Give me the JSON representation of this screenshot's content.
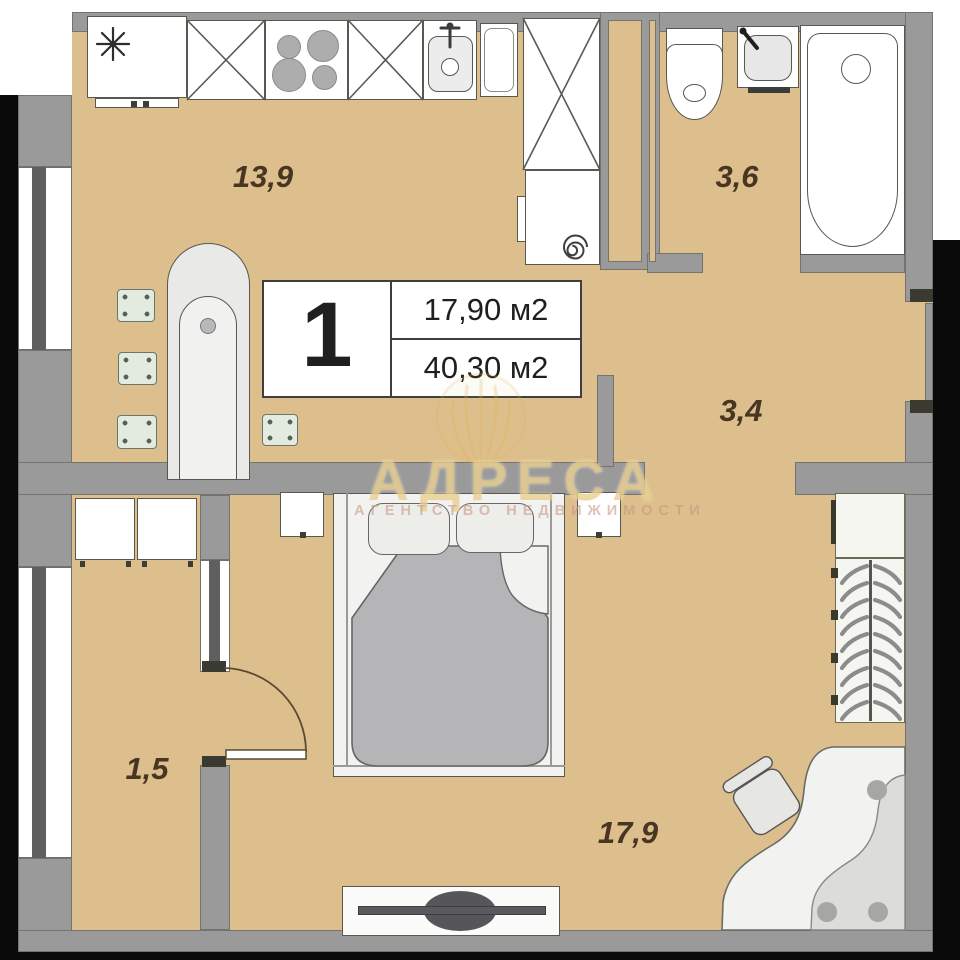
{
  "area_card": {
    "rooms_count": "1",
    "living_area": "17,90 м2",
    "total_area": "40,30 м2"
  },
  "room_labels": {
    "kitchen": "13,9",
    "bathroom": "3,6",
    "hallway": "3,4",
    "balcony": "1,5",
    "living_room": "17,9"
  },
  "watermark": {
    "title": "АДРЕСА",
    "subtitle": "АГЕНТСТВО НЕДВИЖИМОСТИ"
  },
  "colors": {
    "floor": "#ddbf8e",
    "wall": "#9b9a9b",
    "wall_outline": "#74746f",
    "fixture_white": "#ffffff",
    "fixture_outline": "#58584f",
    "label_text": "#483622",
    "card_border": "#3f3f3f",
    "blanket_gray": "#b5b5b7",
    "tv_screen": "#55555a",
    "stool_green": "#e3eadf",
    "watermark_gold": "#e2c376",
    "watermark_subtitle": "#c69680",
    "edge_black": "#0a0a0a"
  }
}
